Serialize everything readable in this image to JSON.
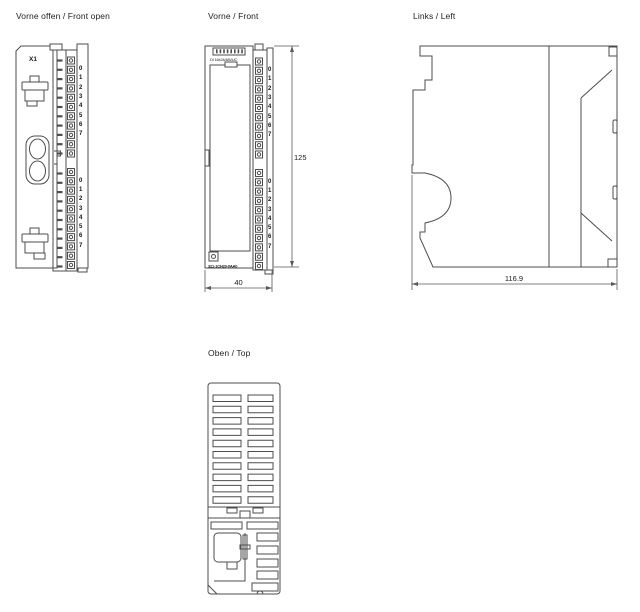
{
  "channels": [
    "0",
    "1",
    "2",
    "3",
    "4",
    "5",
    "6",
    "7"
  ],
  "views": {
    "front_open": {
      "title": "Vorne offen / Front open",
      "connector_label": "X1"
    },
    "front": {
      "title": "Vorne / Front",
      "type_label": "DI 16x24/48VUC",
      "order_number": "321-1CH20-0AA0",
      "dim_height": "125",
      "dim_width": "40"
    },
    "left": {
      "title": "Links / Left",
      "dim_depth": "116.9"
    },
    "top": {
      "title": "Oben / Top"
    }
  },
  "colors": {
    "line": "#4d4d4d",
    "text": "#1a1a1a",
    "background": "#ffffff"
  }
}
